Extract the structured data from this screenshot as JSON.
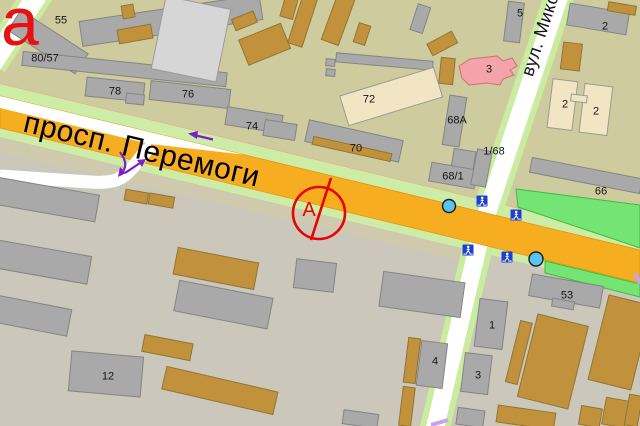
{
  "map": {
    "type": "city-street-map",
    "labels": {
      "corner": "а",
      "avenue": "просп. Перемоги",
      "cross_street": "вул. Микол",
      "marker": "А"
    },
    "buildings": {
      "b55": "55",
      "b80_57": "80/57",
      "b78": "78",
      "b76": "76",
      "b74": "74",
      "b72": "72",
      "b70": "70",
      "b68a": "68А",
      "b68_1": "68/1",
      "b1_68": "1/68",
      "b5": "5",
      "b3_north": "3",
      "b2_gray": "2",
      "b2_cream_left": "2",
      "b2_cream_right": "2",
      "b66": "66",
      "b53": "53",
      "b1_south": "1",
      "b3_south": "3",
      "b4_south": "4",
      "b12": "12"
    },
    "colors": {
      "road_primary": "#f7ad20",
      "road_minor": "#ffffff",
      "road_verge": "#cdeda6",
      "park": "#74e474",
      "block_north": "#cecc9e",
      "block_south": "#cbc7ba",
      "building_gray": "#a9a9a9",
      "building_brown": "#c2913c",
      "building_cream": "#f1e5c3",
      "building_pink": "#f4a3ab",
      "marker_red": "#e80202",
      "stop_blue": "#58c5f1",
      "crossing_blue": "#1e40d2",
      "arrow_purple": "#7b1fc9"
    },
    "icons": [
      {
        "name": "pedestrian-crossing-icon",
        "count": 4
      },
      {
        "name": "transit-stop-icon",
        "count": 2
      }
    ]
  }
}
